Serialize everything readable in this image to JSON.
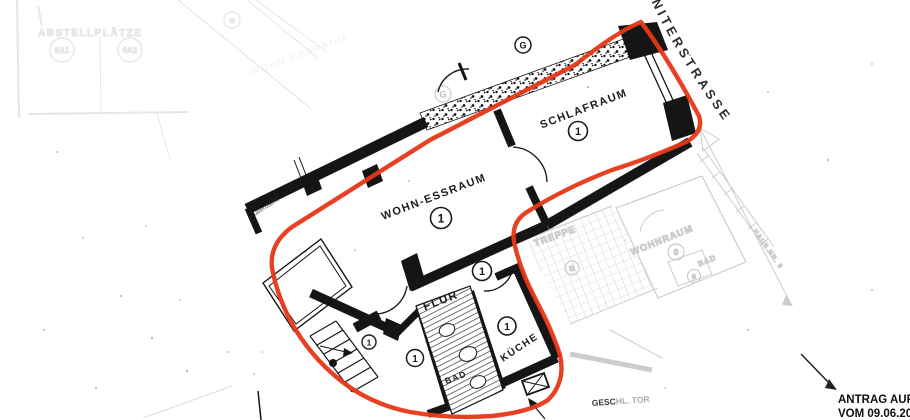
{
  "street": {
    "name": "NNITERSTRASSE"
  },
  "rooms": {
    "schlafraum": {
      "label": "SCHLAFRAUM"
    },
    "wohn_essraum": {
      "label": "WOHN-ESSRAUM"
    },
    "flur": {
      "label": "FLUR"
    },
    "kueche": {
      "label": "KÜCHE"
    },
    "bad": {
      "label": "BAD"
    }
  },
  "markers": {
    "units": [
      "1",
      "1",
      "1",
      "1",
      "1",
      "1"
    ],
    "g_dark": "G",
    "g_faint": "G"
  },
  "neighbor": {
    "treppe": "TREPPE",
    "wohnraum": "WOHNRAUM",
    "wohnraum_number": "9",
    "bad": "BAD",
    "bad_number": "9",
    "g": "G",
    "haus_nr": "HAUS NR. 9"
  },
  "ghost": {
    "abstellplaetze": "ABSTELLPLÄTZE",
    "spot1": "6A1",
    "spot2": "6A2",
    "g": "G",
    "wohn_essraum": "WOHN-ESSRAUM"
  },
  "annotations": {
    "ueberdacht": "überdacht",
    "gate_bold": "GESC",
    "gate_rest": "HL. TOR"
  },
  "footer": {
    "line1": "ANTRAG AUF A",
    "line2": "VOM 09.06.200"
  },
  "colors": {
    "outline_red": "#e63617",
    "ink": "#151515",
    "faded": "#8f8f8f"
  }
}
